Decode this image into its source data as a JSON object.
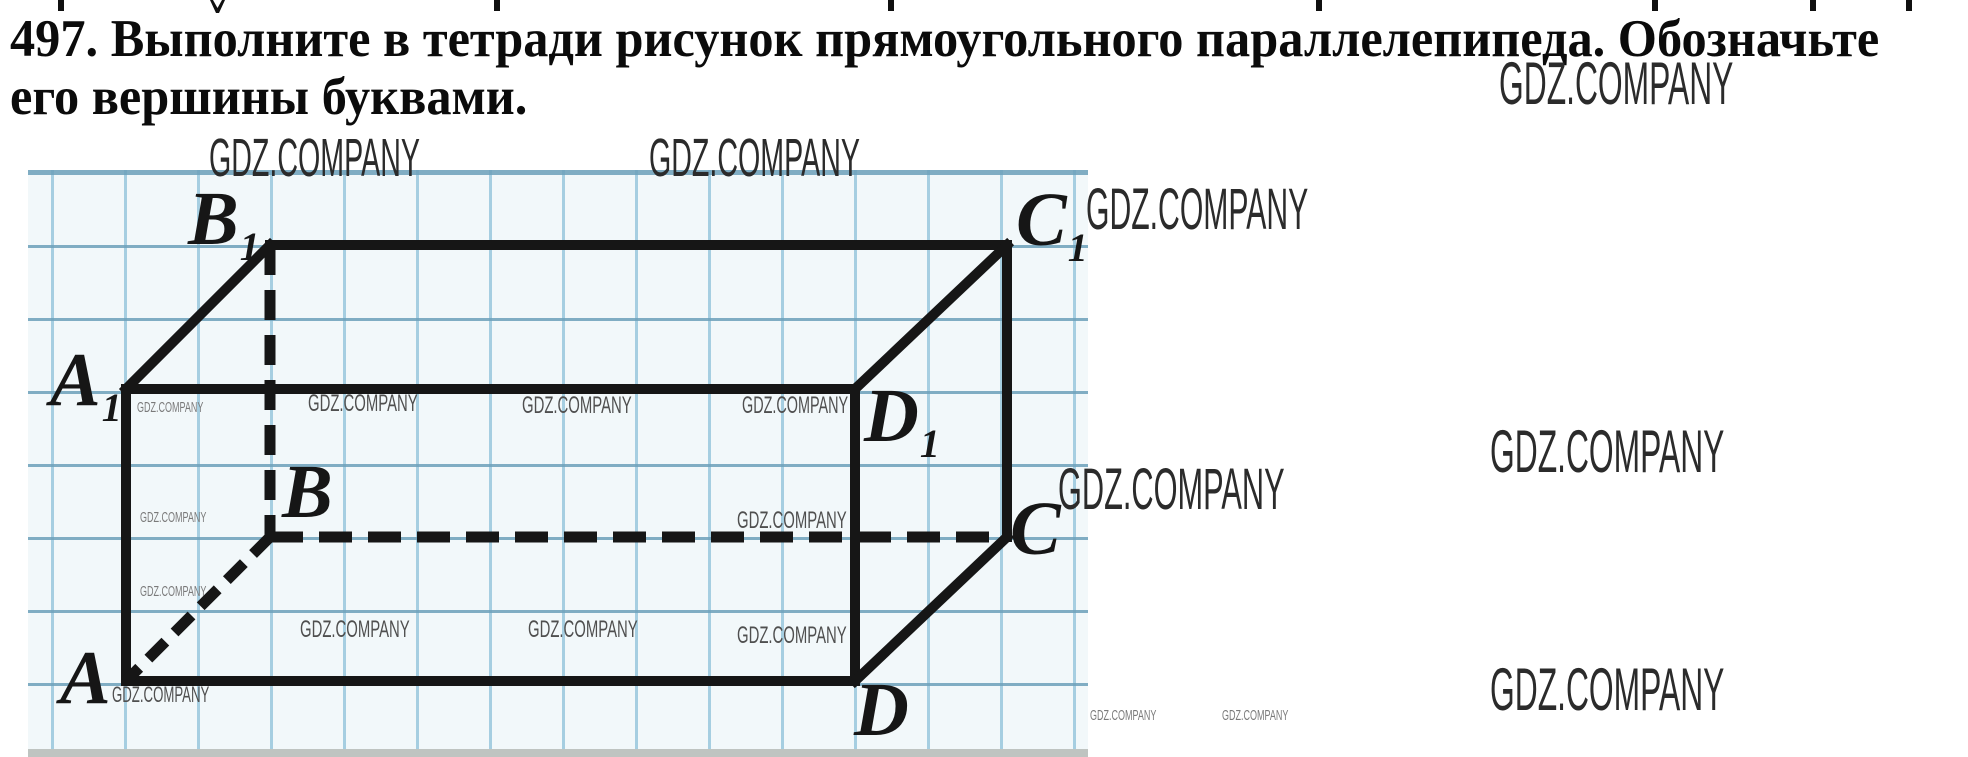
{
  "problem": {
    "line1": "497. Выполните в тетради рисунок прямоугольного параллелепипеда. Обозначьте",
    "line2": "его вершины буквами."
  },
  "watermark_text": "GDZ.COMPANY",
  "colors": {
    "paper": "#f2f8fa",
    "grid_h": "#6ca0ba",
    "grid_v": "#8cc1d8",
    "ink": "#161616",
    "wm_dark": "#2b2b2b",
    "wm_mid": "#4f4f4f",
    "wm_light": "#7a7a7a",
    "strip": "#bfc4c1"
  },
  "top_fragments": [
    {
      "x": 58
    },
    {
      "x": 210,
      "v": true
    },
    {
      "x": 494
    },
    {
      "x": 888
    },
    {
      "x": 1316
    },
    {
      "x": 1652
    },
    {
      "x": 1810
    },
    {
      "x": 1906
    }
  ],
  "figure": {
    "type": "rectangular-parallelepiped",
    "vertices": {
      "A": [
        126,
        681
      ],
      "B": [
        270,
        537
      ],
      "C": [
        1007,
        537
      ],
      "D": [
        855,
        681
      ],
      "A1": [
        126,
        389
      ],
      "B1": [
        270,
        245
      ],
      "C1": [
        1007,
        245
      ],
      "D1": [
        855,
        389
      ]
    },
    "solid_edges": [
      [
        "A1",
        "B1"
      ],
      [
        "B1",
        "C1"
      ],
      [
        "C1",
        "D1"
      ],
      [
        "A1",
        "D1"
      ],
      [
        "A1",
        "A"
      ],
      [
        "D1",
        "D"
      ],
      [
        "C1",
        "C"
      ],
      [
        "A",
        "D"
      ],
      [
        "D",
        "C"
      ]
    ],
    "dashed_edges": [
      {
        "from": "B1",
        "to": "B",
        "dash": "30 15"
      },
      {
        "from": "B",
        "to": "C",
        "dash": "33 16"
      },
      {
        "from": "B",
        "to": "A",
        "dash": "24 13"
      }
    ],
    "labels": [
      {
        "main": "A",
        "sub": "1",
        "x": 50,
        "y": 342
      },
      {
        "main": "B",
        "sub": "1",
        "x": 188,
        "y": 181
      },
      {
        "main": "C",
        "sub": "1",
        "x": 1016,
        "y": 182
      },
      {
        "main": "D",
        "sub": "1",
        "x": 864,
        "y": 378
      },
      {
        "main": "A",
        "sub": "",
        "x": 60,
        "y": 640
      },
      {
        "main": "B",
        "sub": "",
        "x": 282,
        "y": 454
      },
      {
        "main": "C",
        "sub": "",
        "x": 1010,
        "y": 491
      },
      {
        "main": "D",
        "sub": "",
        "x": 854,
        "y": 672
      }
    ]
  },
  "watermarks": [
    {
      "x": 209,
      "y": 131,
      "fs": 54,
      "sx": 0.53,
      "tone": "dark"
    },
    {
      "x": 649,
      "y": 131,
      "fs": 54,
      "sx": 0.53,
      "tone": "dark"
    },
    {
      "x": 1499,
      "y": 54,
      "fs": 60,
      "sx": 0.53,
      "tone": "dark"
    },
    {
      "x": 1086,
      "y": 181,
      "fs": 58,
      "sx": 0.52,
      "tone": "dark"
    },
    {
      "x": 1490,
      "y": 422,
      "fs": 60,
      "sx": 0.53,
      "tone": "dark"
    },
    {
      "x": 1058,
      "y": 461,
      "fs": 58,
      "sx": 0.53,
      "tone": "dark"
    },
    {
      "x": 1490,
      "y": 660,
      "fs": 60,
      "sx": 0.53,
      "tone": "dark"
    },
    {
      "x": 308,
      "y": 392,
      "fs": 24,
      "sx": 0.62,
      "tone": "mid"
    },
    {
      "x": 522,
      "y": 394,
      "fs": 24,
      "sx": 0.62,
      "tone": "mid"
    },
    {
      "x": 742,
      "y": 394,
      "fs": 24,
      "sx": 0.6,
      "tone": "mid"
    },
    {
      "x": 737,
      "y": 509,
      "fs": 24,
      "sx": 0.62,
      "tone": "mid"
    },
    {
      "x": 300,
      "y": 618,
      "fs": 24,
      "sx": 0.62,
      "tone": "mid"
    },
    {
      "x": 528,
      "y": 618,
      "fs": 24,
      "sx": 0.62,
      "tone": "mid"
    },
    {
      "x": 737,
      "y": 624,
      "fs": 24,
      "sx": 0.62,
      "tone": "mid"
    },
    {
      "x": 112,
      "y": 684,
      "fs": 22,
      "sx": 0.6,
      "tone": "mid"
    },
    {
      "x": 137,
      "y": 400,
      "fs": 15,
      "sx": 0.6,
      "tone": "light"
    },
    {
      "x": 140,
      "y": 510,
      "fs": 15,
      "sx": 0.6,
      "tone": "light"
    },
    {
      "x": 140,
      "y": 584,
      "fs": 15,
      "sx": 0.6,
      "tone": "light"
    },
    {
      "x": 1090,
      "y": 708,
      "fs": 15,
      "sx": 0.6,
      "tone": "light"
    },
    {
      "x": 1222,
      "y": 708,
      "fs": 15,
      "sx": 0.6,
      "tone": "light"
    }
  ]
}
